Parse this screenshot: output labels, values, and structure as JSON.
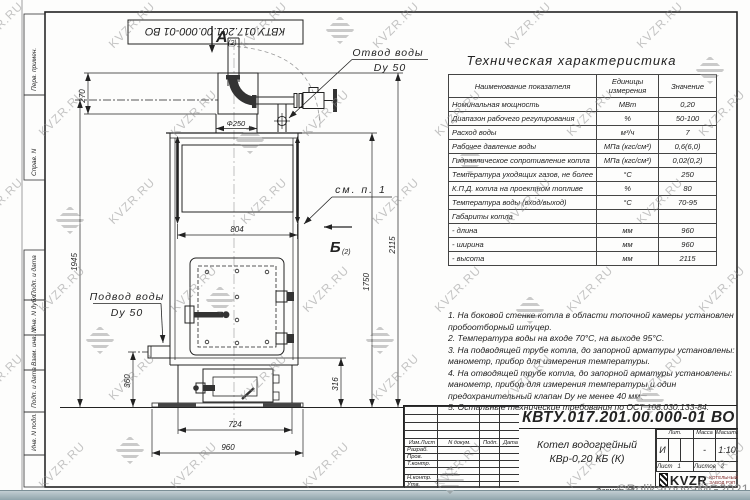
{
  "sheet": {
    "watermark_text": "KVZR.RU",
    "credit_watermark": "©PolikarpovaMG2021",
    "format_label": "Формат А3",
    "top_stamp": "КВТУ.017.201.00.000-01 ВО",
    "margin_labels": [
      "Перв. примен.",
      "Справ. N",
      "Подп. и дата",
      "Инв. N дубл.",
      "Взам. инв. N",
      "Подп. и дата",
      "Инв. N подл."
    ]
  },
  "drawing": {
    "view_a": "А",
    "view_a_sub": "(2)",
    "view_b": "Б",
    "view_b_sub": "(2)",
    "see_note": "см. п. 1",
    "outlet_label": "Отвод воды",
    "outlet_dn": "Dy 50",
    "inlet_label": "Подвод воды",
    "inlet_dn": "Dy 50",
    "dims": {
      "flue_height": "270",
      "flue_dia": "Ф250",
      "body_width": "804",
      "outlet_height": "1945",
      "inlet_height": "360",
      "total_height": "2115",
      "body_height": "1750",
      "base_height": "316",
      "base_width": "724",
      "overall_width": "960"
    }
  },
  "spec_table": {
    "title": "Техническая характеристика",
    "headers": [
      "Наименование показателя",
      "Единицы измерения",
      "Значение"
    ],
    "rows": [
      [
        "Номинальная мощность",
        "МВт",
        "0,20"
      ],
      [
        "Диапазон рабочего регулирования",
        "%",
        "50-100"
      ],
      [
        "Расход воды",
        "м³/ч",
        "7"
      ],
      [
        "Рабочее давление воды",
        "МПа (кгс/см²)",
        "0,6(6,0)"
      ],
      [
        "Гидравлическое сопротивление котла",
        "МПа (кгс/см²)",
        "0,02(0,2)"
      ],
      [
        "Температура уходящих газов, не более",
        "°С",
        "250"
      ],
      [
        "К.П.Д. котла на проектном топливе",
        "%",
        "80"
      ],
      [
        "Температура воды (вход/выход)",
        "°С",
        "70-95"
      ],
      [
        "Габариты котла",
        "",
        ""
      ],
      [
        "   - длина",
        "мм",
        "960"
      ],
      [
        "   - ширина",
        "мм",
        "960"
      ],
      [
        "   - высота",
        "мм",
        "2115"
      ]
    ]
  },
  "notes": [
    "1. На боковой стенке котла в области топочной камеры установлен пробоотборный штуцер.",
    "2. Температура воды на входе 70°С, на выходе 95°С.",
    "3. На подводящей трубе котла, до запорной арматуры установлены: манометр, прибор для измерения температуры.",
    "4. На отводящей трубе котла, до запорной арматуры установлены: манометр, прибор для измерения температуры и один предохранительный клапан Dу не менее 40 мм.",
    "5. Остальные технические требования по ОСТ 108.030.133-84."
  ],
  "title_block": {
    "doc_number": "КВТУ.017.201.00.000-01 ВО",
    "product_name_line1": "Котел водогрейный",
    "product_name_line2": "КВр-0,20 КБ (К)",
    "header_cells": [
      "Изм.Лист",
      "N докум.",
      "Подп.",
      "Дата"
    ],
    "row_labels": [
      "Разраб.",
      "Пров.",
      "Т.контр.",
      "",
      "Н.контр.",
      "Утв."
    ],
    "lit_label": "Лит.",
    "lit_value": "И",
    "mass_label": "Масса",
    "mass_value": "-",
    "scale_label": "Масштаб",
    "scale_value": "1:10",
    "sheet_label": "Лист",
    "sheet_value": "1",
    "sheets_label": "Листов",
    "sheets_value": "2",
    "company_logo": "KVZR",
    "company_line1": "КОТЕЛЬНЫЙ",
    "company_line2": "ЗАВОД РЭП"
  }
}
